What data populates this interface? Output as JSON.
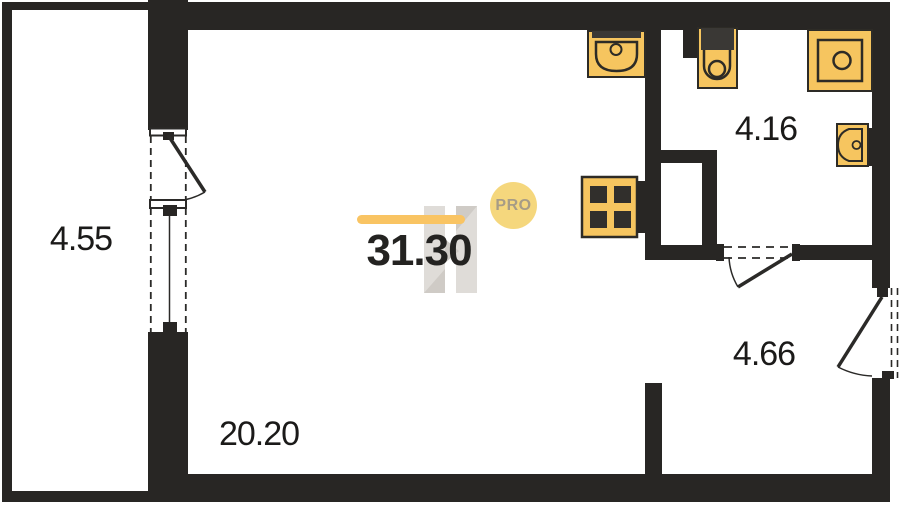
{
  "plan": {
    "title": "studio apartment floor plan",
    "total_area": "31.30",
    "badge_label": "PRO",
    "rooms": {
      "balcony": {
        "name": "balcony",
        "area": "4.55"
      },
      "living": {
        "name": "living-kitchen room",
        "area": "20.20"
      },
      "bathroom": {
        "name": "bathroom",
        "area": "4.16"
      },
      "hallway": {
        "name": "hallway",
        "area": "4.66"
      }
    },
    "fixtures": [
      "kitchen-sink-icon",
      "stove-icon",
      "toilet-icon",
      "shower-icon",
      "bath-sink-icon"
    ],
    "colors": {
      "wall": "#282624",
      "fixture_fill": "#F6C55F",
      "fixture_outline": "#2D2B26",
      "fixture_dark": "#3A3835",
      "accent_bar": "#F9C463",
      "badge_bg": "#F5D77D",
      "badge_text": "#A79C86",
      "watermark_light": "#DAD7D2",
      "watermark_dark": "#C7C3BD"
    }
  }
}
